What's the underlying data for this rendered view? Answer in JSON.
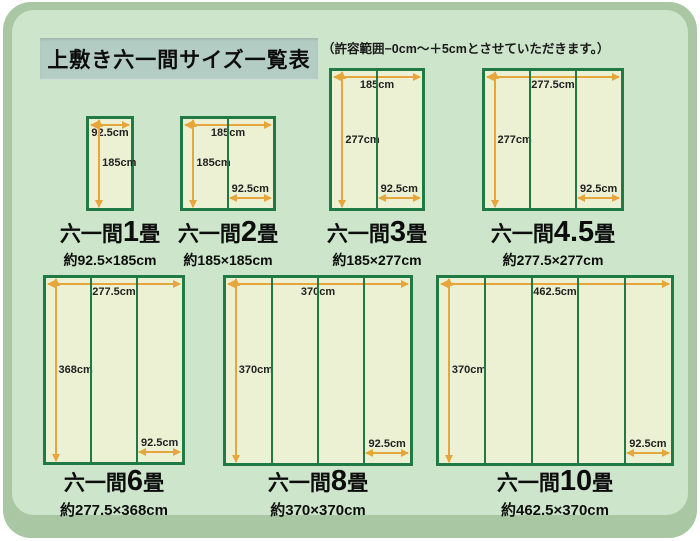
{
  "page": {
    "title": "上敷き六一間サイズ一覧表",
    "note": "（許容範囲−0cm〜＋5cmとさせていただきます。）"
  },
  "colors": {
    "frame_edge": "#a8c7a2",
    "panel_bg": "#cde5cb",
    "title_bg": "#b4cdc4",
    "mat_fill": "#ecf1d3",
    "mat_border": "#1f7a45",
    "arrow": "#e7a63b",
    "text": "#111111"
  },
  "scale_px_per_cm": 0.515,
  "mats": [
    {
      "name_prefix": "六一間",
      "name_num": "1",
      "name_suffix": "畳",
      "size_text": "約92.5×185cm",
      "width_cm": 92.5,
      "height_cm": 185,
      "panels": 1,
      "width_label": "92.5cm",
      "height_label": "185cm",
      "panel_label": null,
      "row": 1,
      "cx": 110
    },
    {
      "name_prefix": "六一間",
      "name_num": "2",
      "name_suffix": "畳",
      "size_text": "約185×185cm",
      "width_cm": 185,
      "height_cm": 185,
      "panels": 2,
      "width_label": "185cm",
      "height_label": "185cm",
      "panel_label": "92.5cm",
      "row": 1,
      "cx": 228
    },
    {
      "name_prefix": "六一間",
      "name_num": "3",
      "name_suffix": "畳",
      "size_text": "約185×277cm",
      "width_cm": 185,
      "height_cm": 277,
      "panels": 2,
      "width_label": "185cm",
      "height_label": "277cm",
      "panel_label": "92.5cm",
      "row": 1,
      "cx": 377
    },
    {
      "name_prefix": "六一間",
      "name_num": "4.5",
      "name_suffix": "畳",
      "size_text": "約277.5×277cm",
      "width_cm": 277.5,
      "height_cm": 277,
      "panels": 3,
      "width_label": "277.5cm",
      "height_label": "277cm",
      "panel_label": "92.5cm",
      "row": 1,
      "cx": 553
    },
    {
      "name_prefix": "六一間",
      "name_num": "6",
      "name_suffix": "畳",
      "size_text": "約277.5×368cm",
      "width_cm": 277.5,
      "height_cm": 368,
      "panels": 3,
      "width_label": "277.5cm",
      "height_label": "368cm",
      "panel_label": "92.5cm",
      "row": 2,
      "cx": 114
    },
    {
      "name_prefix": "六一間",
      "name_num": "8",
      "name_suffix": "畳",
      "size_text": "約370×370cm",
      "width_cm": 370,
      "height_cm": 370,
      "panels": 4,
      "width_label": "370cm",
      "height_label": "370cm",
      "panel_label": "92.5cm",
      "row": 2,
      "cx": 318
    },
    {
      "name_prefix": "六一間",
      "name_num": "10",
      "name_suffix": "畳",
      "size_text": "約462.5×370cm",
      "width_cm": 462.5,
      "height_cm": 370,
      "panels": 5,
      "width_label": "462.5cm",
      "height_label": "370cm",
      "panel_label": "92.5cm",
      "row": 2,
      "cx": 555
    }
  ]
}
